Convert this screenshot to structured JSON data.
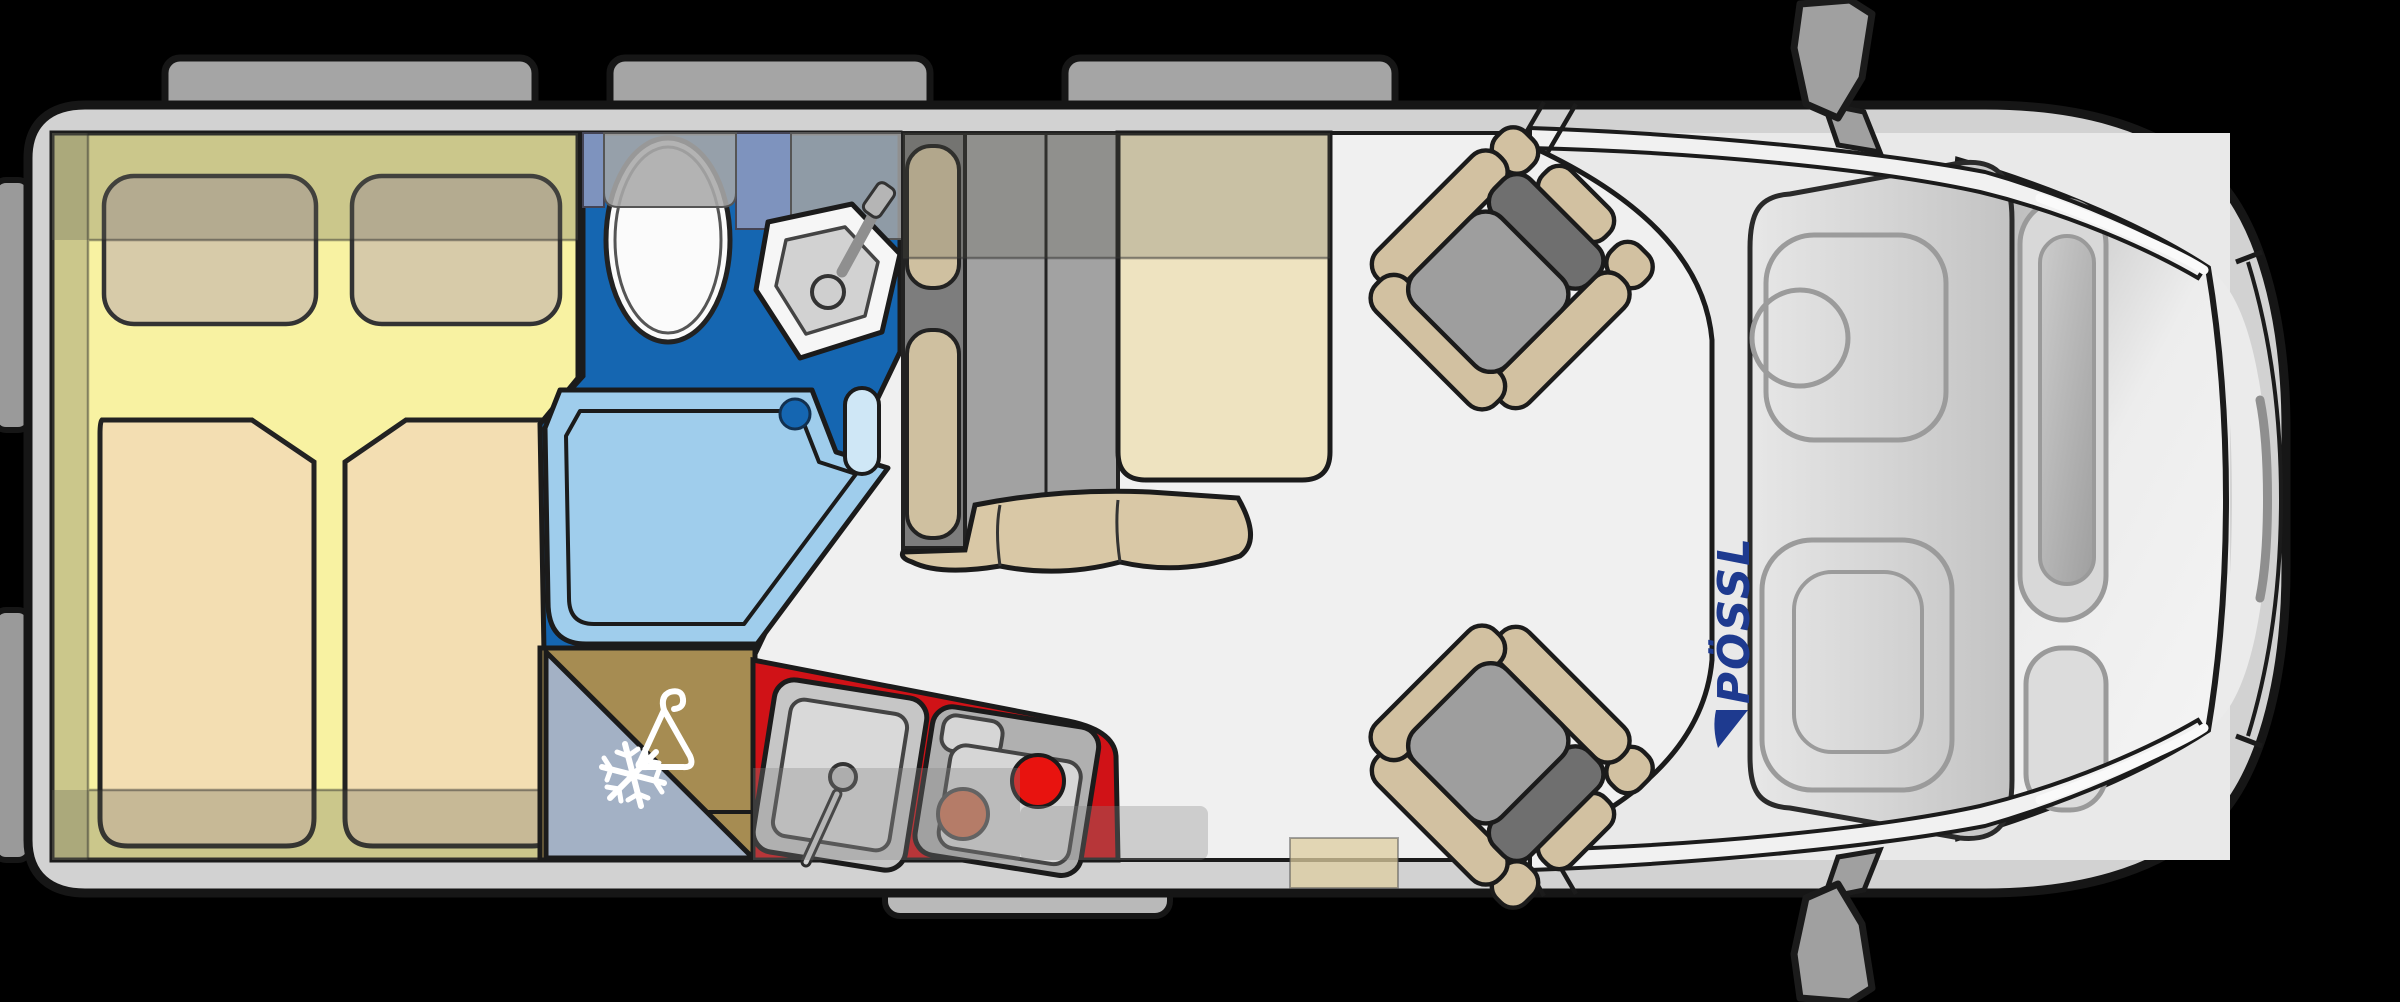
{
  "title": "Camper van floor plan (top view)",
  "brand": {
    "logo_text": "PÖSSL",
    "logo_color": "#1e3a8f"
  },
  "colors": {
    "background": "#000000",
    "body_shell": "#d2d2d2",
    "floor": "#f0f0f0",
    "bed_area": "#f8f2a2",
    "mattress": "#f3deb2",
    "pillow": "#d7cba9",
    "bathroom_floor": "#1566b1",
    "shower_tray": "#9fcdec",
    "wardrobe": "#a68c52",
    "fridge": "#a3b1c5",
    "kitchen_counter": "#d01217",
    "burner_hot": "#e8130f",
    "burner_warm": "#cd7a5c",
    "seat_cushion": "#d2c1a1",
    "seat_pan": "#9e9e9e",
    "table": "#eee3c0",
    "cabinet_overlay": "#8a8a78"
  },
  "rooms": [
    {
      "name": "rear-double-bed",
      "icon": ""
    },
    {
      "name": "bathroom",
      "features": [
        "toilet",
        "corner-sink",
        "shower-tray"
      ],
      "icon": ""
    },
    {
      "name": "wardrobe",
      "icon": "hanger-icon"
    },
    {
      "name": "refrigerator",
      "icon": "snowflake-icon"
    },
    {
      "name": "kitchen",
      "features": [
        "sink",
        "two-burner-stove"
      ],
      "icon": ""
    },
    {
      "name": "dinette",
      "features": [
        "bench-seat",
        "table"
      ],
      "icon": ""
    },
    {
      "name": "cab",
      "features": [
        "swivel-passenger-seat",
        "swivel-driver-seat",
        "dashboard",
        "windshield"
      ],
      "icon": ""
    }
  ]
}
